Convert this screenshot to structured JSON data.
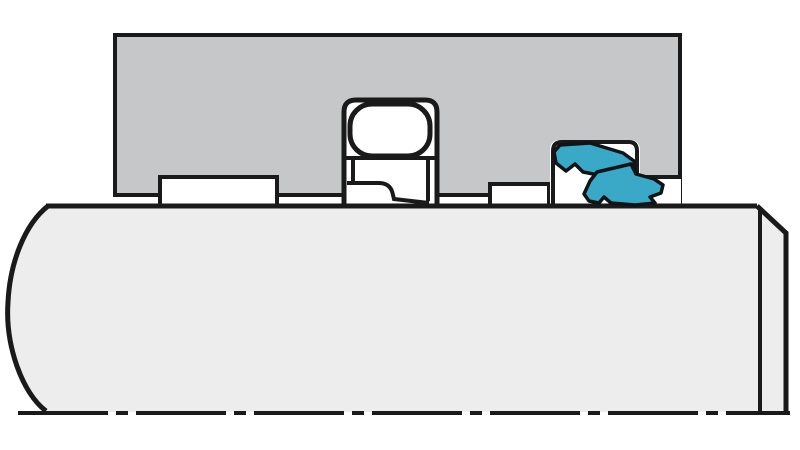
{
  "diagram": {
    "type": "technical-cross-section",
    "description": "Cross-section of a sealed shaft assembly: gray housing block, rotating shaft with chamfered end over a dash-dot centerline, rolling bearing in the center bore, and a blue V-ring seal in a cavity on the right",
    "components": [
      "housing-block",
      "shaft",
      "shaft-centerline",
      "bearing-outer-ring",
      "bearing-ball",
      "bearing-inner-ring",
      "left-groove",
      "right-groove",
      "seal-cavity",
      "v-ring-seal"
    ]
  },
  "colors": {
    "background": "#ffffff",
    "housing_fill": "#c6c7c8",
    "shaft_fill": "#ededee",
    "component_fill": "#ffffff",
    "seal_fill": "#3aa9c8",
    "outline": "#1a1a1a"
  }
}
